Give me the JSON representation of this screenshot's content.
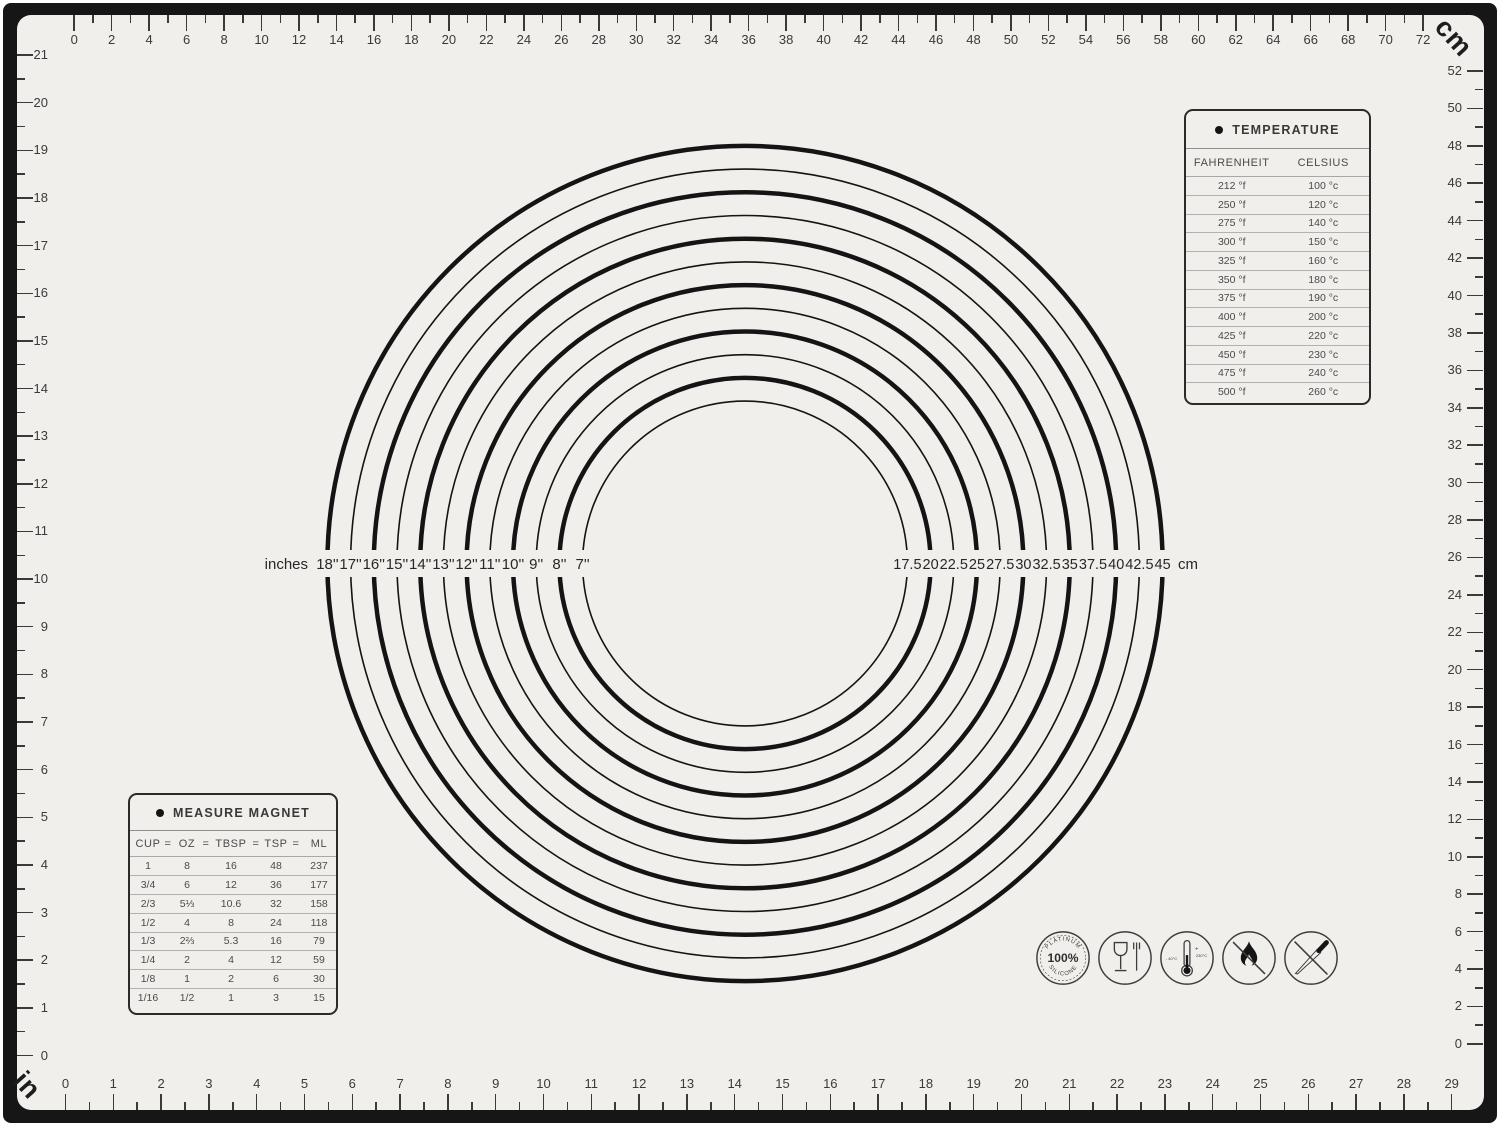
{
  "mat": {
    "unit_top_right": "cm",
    "unit_bottom_left": "in",
    "colors": {
      "mat": "#f0efec",
      "frame": "#161616",
      "ink": "#3a3a3a",
      "ring": "#141414"
    }
  },
  "rulers": {
    "top_cm": {
      "min": 0,
      "max": 72,
      "labels_every": 2
    },
    "right_cm": {
      "min": 0,
      "max": 52,
      "labels_every": 2
    },
    "bottom_in": {
      "min": 0,
      "max": 29,
      "labels_every": 1
    },
    "left_in": {
      "min": 0,
      "max": 21,
      "labels_every": 1
    }
  },
  "circles": {
    "prefix_label": "inches",
    "suffix_label": "cm",
    "rings": [
      {
        "diameter_in": 18,
        "in_label": "18''",
        "cm_label": "45"
      },
      {
        "diameter_in": 17,
        "in_label": "17''",
        "cm_label": "42.5"
      },
      {
        "diameter_in": 16,
        "in_label": "16''",
        "cm_label": "40"
      },
      {
        "diameter_in": 15,
        "in_label": "15''",
        "cm_label": "37.5"
      },
      {
        "diameter_in": 14,
        "in_label": "14''",
        "cm_label": "35"
      },
      {
        "diameter_in": 13,
        "in_label": "13''",
        "cm_label": "32.5"
      },
      {
        "diameter_in": 12,
        "in_label": "12''",
        "cm_label": "30"
      },
      {
        "diameter_in": 11,
        "in_label": "11''",
        "cm_label": "27.5"
      },
      {
        "diameter_in": 10,
        "in_label": "10''",
        "cm_label": "25"
      },
      {
        "diameter_in": 9,
        "in_label": "9''",
        "cm_label": "22.5"
      },
      {
        "diameter_in": 8,
        "in_label": "8''",
        "cm_label": "20"
      },
      {
        "diameter_in": 7,
        "in_label": "7''",
        "cm_label": "17.5"
      }
    ]
  },
  "temperature_table": {
    "title": "TEMPERATURE",
    "columns": [
      "FAHRENHEIT",
      "CELSIUS"
    ],
    "rows": [
      [
        "212 °f",
        "100 °c"
      ],
      [
        "250 °f",
        "120 °c"
      ],
      [
        "275 °f",
        "140 °c"
      ],
      [
        "300 °f",
        "150 °c"
      ],
      [
        "325 °f",
        "160 °c"
      ],
      [
        "350 °f",
        "180 °c"
      ],
      [
        "375 °f",
        "190 °c"
      ],
      [
        "400 °f",
        "200 °c"
      ],
      [
        "425 °f",
        "220 °c"
      ],
      [
        "450 °f",
        "230 °c"
      ],
      [
        "475 °f",
        "240 °c"
      ],
      [
        "500 °f",
        "260 °c"
      ]
    ]
  },
  "measure_table": {
    "title": "MEASURE MAGNET",
    "header_cells": [
      "CUP",
      "=",
      "OZ",
      "=",
      "TBSP",
      "=",
      "TSP",
      "=",
      "ML"
    ],
    "rows": [
      [
        "1",
        "8",
        "16",
        "48",
        "237"
      ],
      [
        "3/4",
        "6",
        "12",
        "36",
        "177"
      ],
      [
        "2/3",
        "5⅓",
        "10.6",
        "32",
        "158"
      ],
      [
        "1/2",
        "4",
        "8",
        "24",
        "118"
      ],
      [
        "1/3",
        "2⅔",
        "5.3",
        "16",
        "79"
      ],
      [
        "1/4",
        "2",
        "4",
        "12",
        "59"
      ],
      [
        "1/8",
        "1",
        "2",
        "6",
        "30"
      ],
      [
        "1/16",
        "1/2",
        "1",
        "3",
        "15"
      ]
    ]
  },
  "icons": {
    "platinum": {
      "top": "PLATINUM",
      "center": "100%",
      "bottom": "SILICONE"
    },
    "temperature_range": {
      "min": "- 40°C",
      "plus": "+",
      "max": "230°C"
    }
  }
}
